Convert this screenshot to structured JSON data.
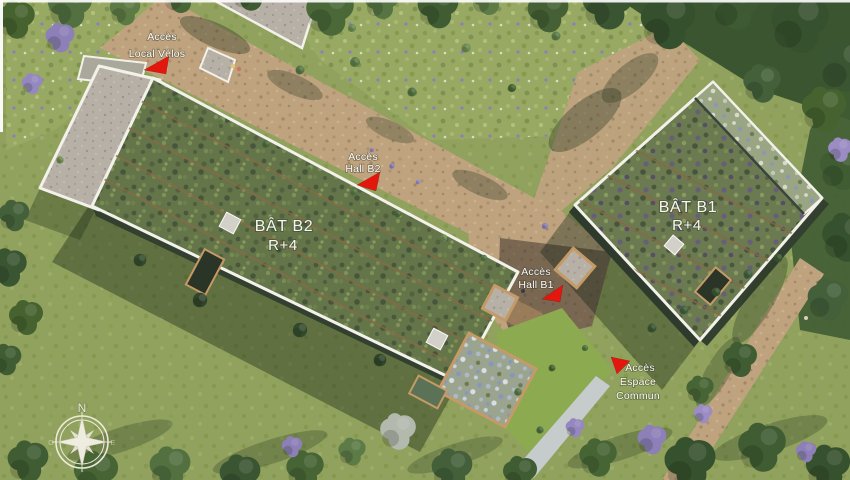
{
  "buildings": [
    {
      "name": "BÂT B2",
      "floors": "R+4"
    },
    {
      "name": "BÂT B1",
      "floors": "R+4"
    }
  ],
  "access_markers": [
    {
      "id": "local-velos",
      "lines": [
        "Accès",
        "Local Vélos"
      ]
    },
    {
      "id": "hall-b2",
      "lines": [
        "Accès",
        "Hall B2"
      ]
    },
    {
      "id": "hall-b1",
      "lines": [
        "Accès",
        "Hall B1"
      ]
    },
    {
      "id": "espace-commun",
      "lines": [
        "Accès",
        "Espace",
        "Commun"
      ]
    }
  ],
  "compass": {
    "north": "N",
    "west": "O",
    "east": "E"
  },
  "colors": {
    "marker_red": "#e3170d",
    "label_text": "#ffffff",
    "lawn": "#91a25e",
    "roof_vegetation": "#64754a",
    "gravel": "#b7b0a6",
    "path": "#bfa37f",
    "parapet": "#f2f1ea",
    "tree_dark": "#3c5833",
    "flower_purple": "#8d7fb8",
    "courtyard_floor": "#6a5b4d",
    "pale_path": "#c9ced3",
    "planter_trim": "#c49a66",
    "facade_shadow": "#33402f"
  }
}
